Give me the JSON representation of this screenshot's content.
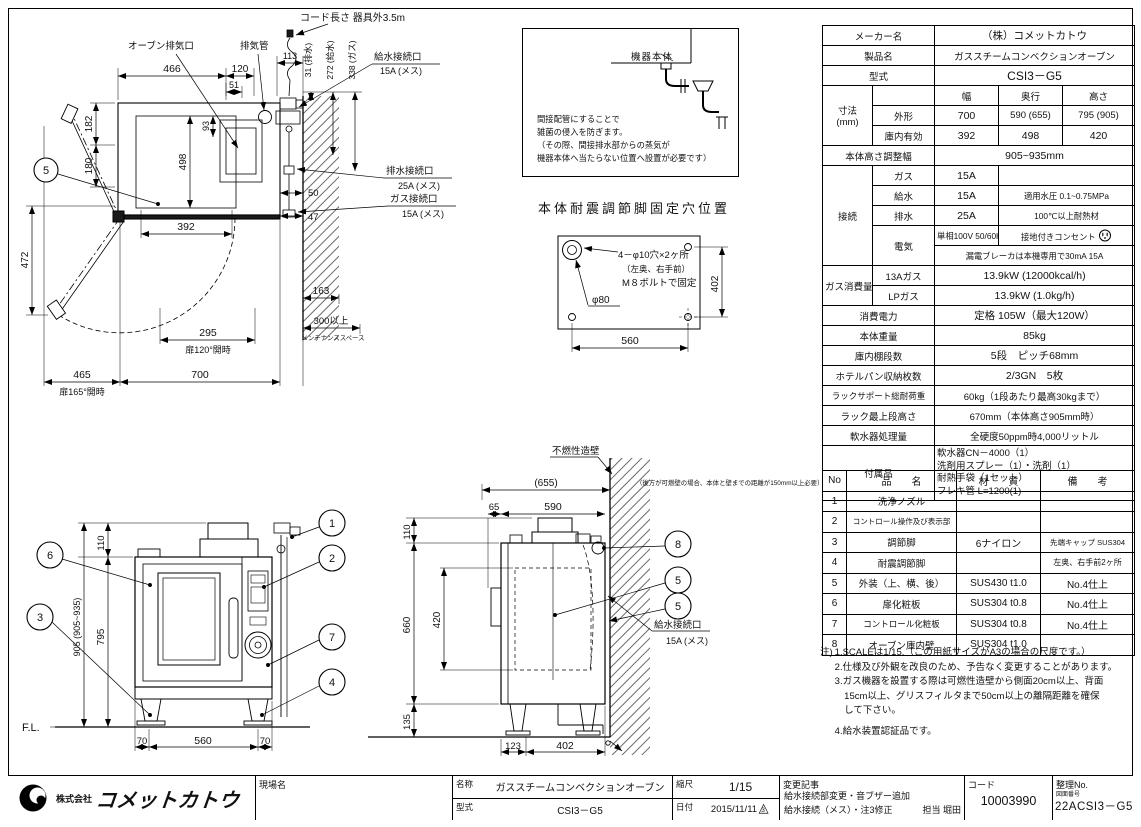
{
  "plan_view": {
    "cord_note": "コード長さ 器具外3.5m",
    "exhaust_port": "オーブン排気口",
    "exhaust_pipe": "排気管",
    "water_label": "給水接続口",
    "water_size": "15A (メス)",
    "drain_label": "排水接続口",
    "drain_size": "25A (メス)",
    "gas_label": "ガス接続口",
    "gas_size": "15A (メス)",
    "d466": "466",
    "d120": "120",
    "d51": "51",
    "d113": "113",
    "d182": "182",
    "d180": "180",
    "d472": "472",
    "d498": "498",
    "d93": "93",
    "d392": "392",
    "d50": "50",
    "d47": "47",
    "d31": "31 (排水)",
    "d272": "272 (給水)",
    "d338": "338 (ガス)",
    "d163": "163",
    "d300": "300以上",
    "maintenance": "メンテナンススペース",
    "d295": "295",
    "door120": "扉120°開時",
    "d465": "465",
    "door165": "扉165°開時",
    "d700": "700",
    "balloon5": "5"
  },
  "detail_box": {
    "body_label": "機器本体",
    "lines": [
      "間接配管にすることで",
      "雑菌の侵入を防ぎます。",
      "（その際、間接排水部からの蒸気が",
      "機器本体へ当たらない位置へ設置が必要です）"
    ]
  },
  "fixing_detail": {
    "title": "本体耐震調節脚固定穴位置",
    "holes": "4－φ10穴×2ヶ所",
    "holes_sub": "（左奥、右手前）",
    "bolt": "M８ボルトで固定",
    "phi80": "φ80",
    "d402": "402",
    "d560": "560"
  },
  "front_view": {
    "d110": "110",
    "d905": "905 (905~935)",
    "d795": "795",
    "d70a": "70",
    "d560": "560",
    "d70b": "70",
    "fl": "F.L.",
    "b1": "1",
    "b2": "2",
    "b3": "3",
    "b4": "4",
    "b6": "6",
    "b7": "7"
  },
  "side_view": {
    "wall_label": "不燃性造壁",
    "wall_note": "（後方が可燃壁の場合、本体と壁までの距離が150mm以上必要）",
    "d655": "(655)",
    "d110": "110",
    "d65": "65",
    "d590": "590",
    "d660": "660",
    "d420": "420",
    "d135": "135",
    "d123": "123",
    "d402": "402",
    "water_label": "給水接続口",
    "water_size": "15A (メス)",
    "b8": "8",
    "b5a": "5",
    "b5b": "5"
  },
  "spec": {
    "maker_label": "メーカー名",
    "maker": "（株）コメットカトウ",
    "product_label": "製品名",
    "product": "ガススチームコンベクションオーブン",
    "model_label": "型式",
    "model": "CSI3－G5",
    "dim_label": "寸法",
    "dim_unit": "(mm)",
    "w_label": "幅",
    "d_label": "奥行",
    "h_label": "高さ",
    "outer_label": "外形",
    "outer_w": "700",
    "outer_d": "590 (655)",
    "outer_h": "795 (905)",
    "inner_label": "庫内有効",
    "inner_w": "392",
    "inner_d": "498",
    "inner_h": "420",
    "height_adj_label": "本体高さ調整幅",
    "height_adj": "905~935mm",
    "conn_label": "接続",
    "gas_label": "ガス",
    "gas": "15A",
    "water_label": "給水",
    "water": "15A",
    "water_note": "適用水圧 0.1~0.75MPa",
    "drain_label": "排水",
    "drain": "25A",
    "drain_note": "100℃以上耐熱材",
    "elec_label": "電気",
    "elec": "単相100V 50/60Hz",
    "elec_note": "接地付きコンセント",
    "breaker": "漏電ブレーカは本機専用で30mA 15A",
    "gascons_label": "ガス消費量",
    "gas13_label": "13Aガス",
    "gas13": "13.9kW (12000kcal/h)",
    "lp_label": "LPガス",
    "lp": "13.9kW (1.0kg/h)",
    "power_label": "消費電力",
    "power": "定格 105W（最大120W）",
    "weight_label": "本体重量",
    "weight": "85kg",
    "shelf_label": "庫内棚段数",
    "shelf": "5段　ピッチ68mm",
    "pan_label": "ホテルパン収納枚数",
    "pan": "2/3GN　5枚",
    "rack_load_label": "ラックサポート総耐荷重",
    "rack_load": "60kg（1段あたり最高30kgまで）",
    "rack_top_label": "ラック最上段高さ",
    "rack_top": "670mm（本体高さ905mm時）",
    "softener_label": "軟水器処理量",
    "softener": "全硬度50ppm時4,000リットル",
    "acc_label": "付属品",
    "acc": [
      "軟水器CN－4000（1）",
      "洗剤用スプレー（1）・洗剤（1）",
      "耐熱手袋（1セット）",
      "フレキ管 L=1200(1)"
    ]
  },
  "parts": {
    "h_no": "No",
    "h_name": "品　　名",
    "h_mat": "材　　質",
    "h_rem": "備　　考",
    "rows": [
      {
        "no": "1",
        "name": "洗浄ノズル",
        "mat": "",
        "rem": ""
      },
      {
        "no": "2",
        "name": "コントロール操作及び表示部",
        "mat": "",
        "rem": ""
      },
      {
        "no": "3",
        "name": "調節脚",
        "mat": "6ナイロン",
        "rem": "先端キャップ SUS304"
      },
      {
        "no": "4",
        "name": "耐震調節脚",
        "mat": "",
        "rem": "左奥、右手前2ヶ所"
      },
      {
        "no": "5",
        "name": "外装（上、横、後）",
        "mat": "SUS430 t1.0",
        "rem": "No.4仕上"
      },
      {
        "no": "6",
        "name": "扉化粧板",
        "mat": "SUS304 t0.8",
        "rem": "No.4仕上"
      },
      {
        "no": "7",
        "name": "コントロール化粧板",
        "mat": "SUS304 t0.8",
        "rem": "No.4仕上"
      },
      {
        "no": "8",
        "name": "オーブン庫内壁",
        "mat": "SUS304 t1.0",
        "rem": ""
      }
    ]
  },
  "notes": {
    "prefix": "注)",
    "lines": [
      "1.SCALEは1/15.（この用紙サイズがA3の場合の尺度です。）",
      "2.仕様及び外観を改良のため、予告なく変更することがあります。",
      "3.ガス機器を設置する際は可燃性造壁から側面20cm以上、背面",
      "　15cm以上、グリスフィルタまで50cm以上の離隔距離を確保",
      "　して下さい。",
      "4.給水装置認証品です。"
    ]
  },
  "title_block": {
    "company_small": "株式会社",
    "company_large": "コメットカトウ",
    "site_label": "現場名",
    "name_label": "名称",
    "name_value": "ガススチームコンベクションオーブン",
    "model_label": "型式",
    "model_value": "CSI3－G5",
    "scale_label": "縮尺",
    "scale_value": "1/15",
    "date_label": "日付",
    "date_value": "2015/11/11",
    "rev_mark": "3",
    "changes_label": "変更記事",
    "changes_line1": "給水接続部変更・音ブザー追加",
    "changes_line2": "給水接続（メス）・注3修正",
    "person": "担当 堀田",
    "code_label": "コード",
    "code_value": "10003990",
    "ref_label": "整理No.",
    "ref_sub": "図面番号",
    "ref_value": "22ACSI3－G5"
  }
}
